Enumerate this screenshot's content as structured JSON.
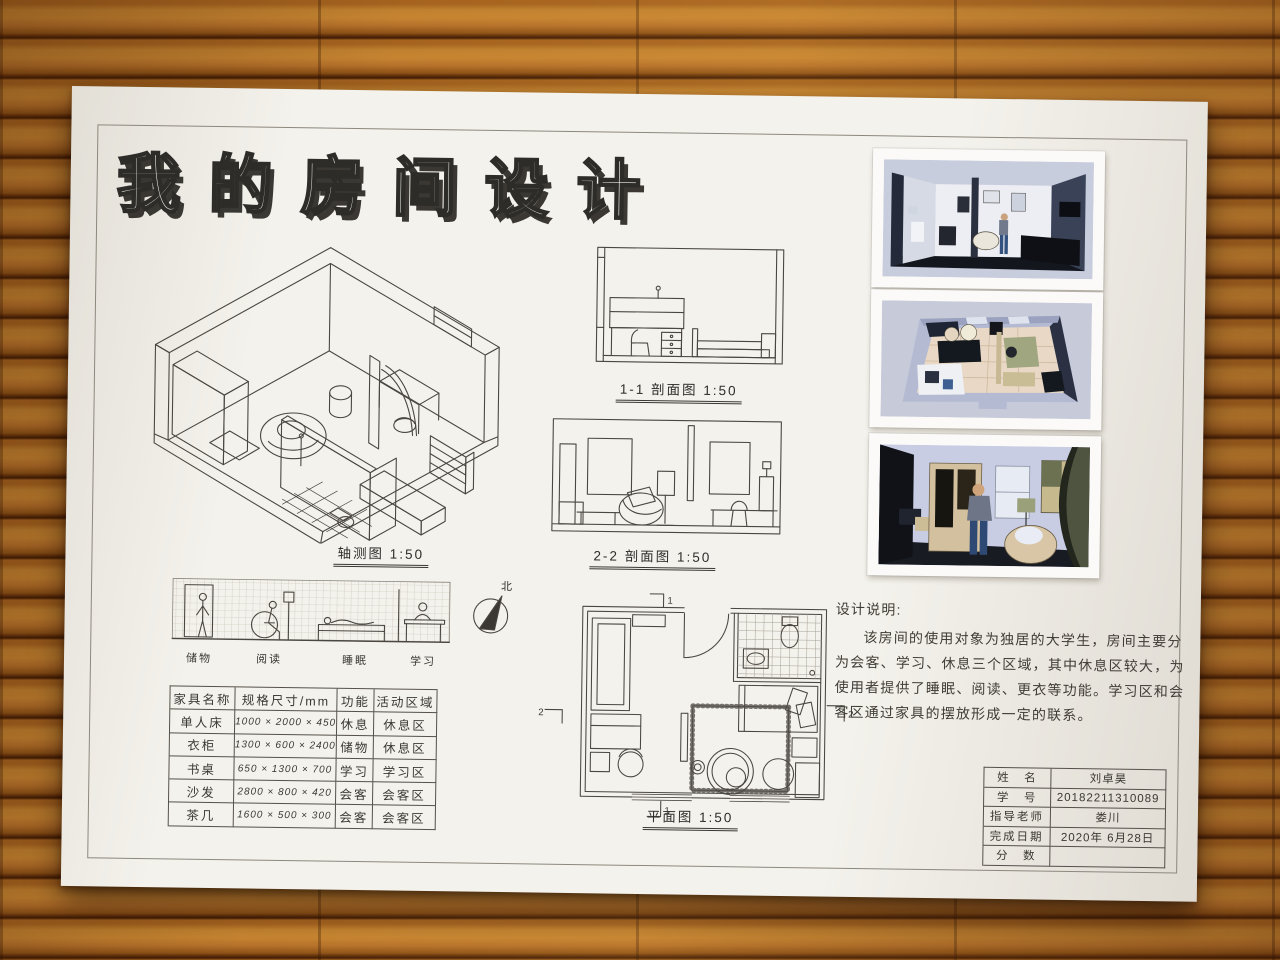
{
  "title": "我的房间设计",
  "drawings": {
    "axon_label": "轴测图 1:50",
    "section1_label": "1-1 剖面图 1:50",
    "section2_label": "2-2 剖面图 1:50",
    "plan_label": "平面图 1:50",
    "north_label": "北",
    "mark_top": "1",
    "mark_bottom": "1",
    "mark_left": "2",
    "mark_right": "2"
  },
  "elevation_labels": [
    "储物",
    "阅读",
    "睡眠",
    "学习"
  ],
  "furniture": {
    "headers": [
      "家具名称",
      "规格尺寸/mm",
      "功能",
      "活动区域"
    ],
    "rows": [
      [
        "单人床",
        "1000 × 2000 × 450",
        "休息",
        "休息区"
      ],
      [
        "衣柜",
        "1300 × 600 × 2400",
        "储物",
        "休息区"
      ],
      [
        "书桌",
        "650 × 1300 × 700",
        "学习",
        "学习区"
      ],
      [
        "沙发",
        "2800 × 800 × 420",
        "会客",
        "会客区"
      ],
      [
        "茶几",
        "1600 × 500 × 300",
        "会客",
        "会客区"
      ]
    ]
  },
  "notes": {
    "heading": "设计说明:",
    "body": "该房间的使用对象为独居的大学生，房间主要分为会客、学习、休息三个区域，其中休息区较大，为使用者提供了睡眠、阅读、更衣等功能。学习区和会客区通过家具的摆放形成一定的联系。"
  },
  "title_block": {
    "labels": [
      "姓　名",
      "学　号",
      "指导老师",
      "完成日期",
      "分　数"
    ],
    "values": [
      "刘卓昊",
      "20182211310089",
      "娄川",
      "2020年 6月28日",
      ""
    ]
  },
  "colors": {
    "wood_light": "#c0812f",
    "wood_dark": "#5d2d0a",
    "paper": "#f4f2ec",
    "ink": "#4a4641",
    "render_sky": "#c8cdde",
    "render_dark_wall": "#2b3142",
    "render_floor_dark": "#14161d",
    "render_floor_beige": "#e9d8c5",
    "render_olive": "#99a07d",
    "render_tan": "#d3c09e",
    "render_denim": "#33517e"
  }
}
